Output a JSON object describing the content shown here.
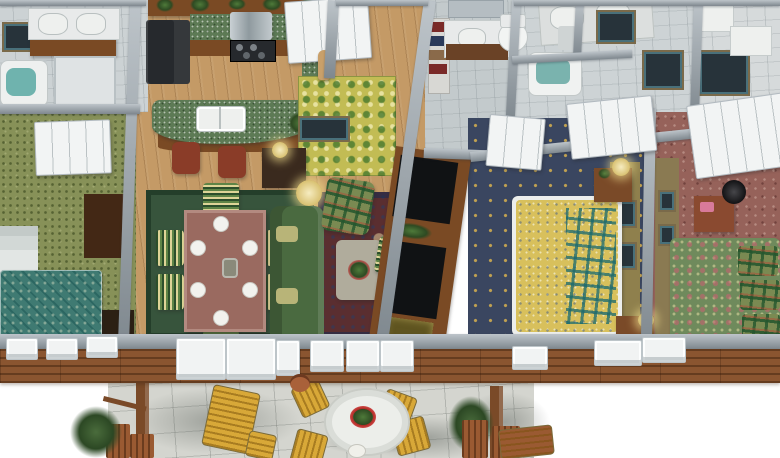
{
  "scene": {
    "description": "3D isometric cutaway (dollhouse) floor plan rendering of an apartment with rear deck patio",
    "view": "birds-eye-angled",
    "background": "#ffffff",
    "text_visible": "none"
  },
  "palette": {
    "background": "#ffffff",
    "wallCap": "#9aa5ad",
    "tileBathMaster": "#ccd2d4",
    "tileBathHall": "#c3cacc",
    "tileBathGuest": "#cdd3d5",
    "tileUtility": "#d6dadb",
    "woodFloor": "#c49a66",
    "woodCabinet": "#7a4a24",
    "counterGreen": "#5d7a55",
    "applianceDark": "#26292d",
    "stainless": "#aab2b6",
    "stoolRed": "#8a3c28",
    "carpetGreen": "#879158",
    "carpetNavy": "#3a4660",
    "carpetMauve": "#96625a",
    "rugDiningGreen": "#37543c",
    "rugOrientalRed": "#5a2e30",
    "foyerRug": "#c2bc54",
    "sofaGreen": "#4a6a40",
    "armchairGreen": "#7a8a52",
    "chairStripeBase": "#aaa04a",
    "tableMauve": "#9a6a60",
    "coffeeTableStone": "#b0ac9c",
    "mediaBlack": "#101214",
    "bedTeal": "#3f7a72",
    "bedYellow": "#d8c05c",
    "bedPaisleyGreen": "#6f8a5c",
    "wallOlive": "#8f804d",
    "wallKhaki": "#8a7a52",
    "nightstandWood": "#7a4a28",
    "dresserWhite": "#e2e6e4",
    "armoireDark": "#432815",
    "doorWhite": "#f2f4f4",
    "deckWood": "#8a5530",
    "patioStone": "#d4d5cf",
    "patioYellow": "#d8a838",
    "terracotta": "#a9613a",
    "postBrown": "#7a4a28",
    "planterWood": "#9a5a32",
    "shrubGreen": "#46663a",
    "whiteFixture": "#eef0ee"
  },
  "rooms": [
    {
      "name": "master-bathroom",
      "area": "top-left",
      "floor": "tile",
      "features": [
        "double-vanity",
        "two-sinks",
        "garden-tub",
        "shower",
        "wall-art"
      ]
    },
    {
      "name": "kitchen",
      "area": "top-center-left",
      "floor": "hardwood",
      "features": [
        "refrigerator",
        "range",
        "range-hood",
        "l-shaped-counter",
        "curved-island-bar",
        "double-sink",
        "bar-stools-x3",
        "potted-plants"
      ]
    },
    {
      "name": "foyer",
      "area": "top-center",
      "floor": "hardwood",
      "features": [
        "front-door",
        "floral-rug",
        "console-table",
        "table-lamp",
        "statue",
        "painting"
      ]
    },
    {
      "name": "hall-bathroom",
      "area": "top-center-right",
      "floor": "tile",
      "features": [
        "mirror",
        "vanity-sink",
        "linen-shelves-towels",
        "toilet"
      ]
    },
    {
      "name": "guest-bathroom",
      "area": "top-right",
      "floor": "tile",
      "features": [
        "double-pedestal-sinks",
        "bathtub",
        "framed-art-x3",
        "white-fixtures"
      ]
    },
    {
      "name": "bedroom-left",
      "area": "left",
      "floor": "green-patterned-carpet",
      "features": [
        "teal-bed",
        "closet-double-doors",
        "white-dresser",
        "dark-armoire",
        "chest"
      ]
    },
    {
      "name": "dining-room",
      "area": "center-left",
      "floor": "hardwood",
      "features": [
        "green-area-rug",
        "dining-table",
        "striped-chairs-x6",
        "place-settings-x6",
        "centerpiece"
      ]
    },
    {
      "name": "living-room",
      "area": "center",
      "floor": "hardwood",
      "features": [
        "oriental-rug",
        "green-sofa",
        "plaid-armchair",
        "coffee-table-flowers",
        "striped-ottomans-x2",
        "entertainment-center",
        "table-lamp"
      ]
    },
    {
      "name": "master-bedroom",
      "area": "center-right",
      "floor": "navy-carpet-gold-diamonds",
      "features": [
        "yellow-plaid-bed",
        "white-bed-frame",
        "nightstands-x2",
        "lamps",
        "paneled-door",
        "closet",
        "olive-wall-art"
      ]
    },
    {
      "name": "bedroom-right",
      "area": "right",
      "floor": "mauve-carpet",
      "features": [
        "paisley-plaid-bed",
        "bifold-closet-doors",
        "nightstand",
        "black-lamp",
        "khaki-wall-art"
      ]
    },
    {
      "name": "deck-patio",
      "area": "bottom",
      "floor": "stone-pavers",
      "features": [
        "round-table",
        "flower-centerpiece",
        "yellow-chairs-x4",
        "chaise-lounge",
        "ottoman",
        "pergola-posts",
        "wood-planters",
        "shrubs",
        "steps",
        "terracotta-pot",
        "tree-shadows",
        "french-doors",
        "front-wall-windows",
        "wood-deck-edge"
      ]
    }
  ]
}
